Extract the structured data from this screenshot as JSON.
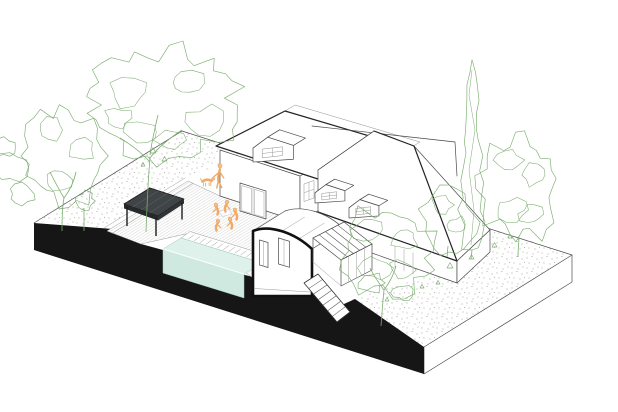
{
  "scene": {
    "kind": "architectural-axonometric-cutaway-illustration",
    "elements": [
      "garden-site-slab",
      "left-garden",
      "right-garden",
      "swimming-pool",
      "timber-deck",
      "pergola",
      "main-house",
      "roof-dormers",
      "sectioned-extension",
      "glazed-veranda",
      "exterior-stairs",
      "people-figures",
      "trees-and-shrubs"
    ]
  },
  "colors": {
    "background": "#ffffff",
    "line_dark": "#262626",
    "line_mid": "#4a4a4a",
    "line_light": "#9a9a9a",
    "poche_black": "#161616",
    "section_stroke": "#111111",
    "pool_water_top": "#def1ea",
    "pool_water_front": "#cfe9e1",
    "pool_line": "#9fccc2",
    "pergola_top": "#3f4446",
    "pergola_side": "#26292b",
    "pergola_side2": "#303436",
    "pergola_joist": "#5a5f61",
    "vegetation_green": "#7cad70",
    "figure_orange": "#f2a965",
    "figure_orange_dark": "#e2913f",
    "figure_skin": "#f6bd8a",
    "deck_hatch": "#b3b5b1",
    "stipple_gray": "#93978e",
    "table_line": "#c9c9c9"
  },
  "vegetation": [
    {
      "name": "large-tree-left",
      "kind": "canopy",
      "cx": 163,
      "cy": 105,
      "rx": 74,
      "ry": 54,
      "seed": 11,
      "clumps": [
        [
          128,
          92,
          20,
          14
        ],
        [
          186,
          83,
          18,
          13
        ],
        [
          204,
          122,
          20,
          15
        ],
        [
          142,
          132,
          17,
          12
        ],
        [
          118,
          118,
          13,
          10
        ],
        [
          170,
          140,
          15,
          10
        ]
      ],
      "trunk": [
        "M146,232 C147,205 148,180 150,158",
        "M150,158 C158,147 170,138 182,130",
        "M150,162 C141,152 130,144 120,138",
        "M150,155 C152,140 155,128 158,115"
      ]
    },
    {
      "name": "tree-left",
      "kind": "canopy",
      "cx": 64,
      "cy": 156,
      "rx": 42,
      "ry": 48,
      "seed": 22,
      "clumps": [
        [
          52,
          130,
          14,
          11
        ],
        [
          80,
          150,
          13,
          11
        ],
        [
          58,
          180,
          14,
          10
        ]
      ],
      "trunk": [
        "M62,231 C62,215 63,203 64,198",
        "M64,198 C58,188 54,180 50,172",
        "M64,198 C70,190 74,182 76,172"
      ]
    },
    {
      "name": "shrubs-left-edge",
      "kind": "blob",
      "blobs": [
        [
          10,
          168,
          17,
          14,
          31
        ],
        [
          22,
          194,
          13,
          10,
          32
        ],
        [
          4,
          148,
          11,
          9,
          33
        ]
      ]
    },
    {
      "name": "sapling-by-pergola",
      "kind": "canopy",
      "cx": 85,
      "cy": 201,
      "rx": 9,
      "ry": 9,
      "seed": 44,
      "clumps": [],
      "trunk": [
        "M84,231 L84,208"
      ]
    },
    {
      "name": "cypress-right",
      "kind": "cypress",
      "cx": 472,
      "top": 60,
      "bottom": 250,
      "w": 14,
      "seed": 55,
      "trunk": [
        "M472,250 L471,259"
      ]
    },
    {
      "name": "bushy-tree-right",
      "kind": "canopy",
      "cx": 520,
      "cy": 189,
      "rx": 38,
      "ry": 52,
      "seed": 66,
      "clumps": [
        [
          508,
          160,
          13,
          10
        ],
        [
          534,
          175,
          12,
          10
        ],
        [
          512,
          210,
          14,
          11
        ],
        [
          531,
          214,
          11,
          9
        ]
      ],
      "trunk": [
        "M518,257 C518,248 519,242 519,236"
      ]
    },
    {
      "name": "tree-center-front",
      "kind": "canopy",
      "cx": 387,
      "cy": 251,
      "rx": 48,
      "ry": 43,
      "seed": 77,
      "clumps": [
        [
          368,
          230,
          14,
          11
        ],
        [
          404,
          238,
          13,
          10
        ],
        [
          376,
          268,
          15,
          11
        ],
        [
          402,
          270,
          12,
          9
        ]
      ],
      "trunk": [
        "M381,326 C382,312 383,300 384,290",
        "M384,290 C378,282 374,276 370,268",
        "M384,290 C390,282 394,274 396,266"
      ]
    },
    {
      "name": "tree-by-house-right",
      "kind": "canopy",
      "cx": 449,
      "cy": 222,
      "rx": 27,
      "ry": 35,
      "seed": 88,
      "clumps": [
        [
          442,
          205,
          10,
          8
        ],
        [
          458,
          225,
          10,
          8
        ]
      ],
      "trunk": [
        "M447,257 L448,246"
      ]
    },
    {
      "name": "shrubs-right",
      "kind": "blob",
      "blobs": [
        [
          371,
          283,
          13,
          9,
          91
        ],
        [
          403,
          293,
          10,
          7,
          92
        ]
      ]
    },
    {
      "name": "ground-tufts",
      "kind": "tris",
      "pts": [
        [
          150,
          153,
          6
        ],
        [
          162,
          161,
          5
        ],
        [
          141,
          166,
          4
        ],
        [
          447,
          268,
          6
        ],
        [
          469,
          259,
          5
        ],
        [
          492,
          247,
          5
        ],
        [
          436,
          284,
          4
        ],
        [
          508,
          238,
          4
        ],
        [
          385,
          301,
          4
        ],
        [
          420,
          288,
          4
        ]
      ]
    }
  ],
  "figures": {
    "standing_person": {
      "x": 220,
      "y": 166
    },
    "dog": {
      "x": 207,
      "y": 181
    },
    "seated_group": {
      "cx": 224,
      "cy": 214,
      "members": [
        {
          "x": 216,
          "y": 205
        },
        {
          "x": 227,
          "y": 202
        },
        {
          "x": 235,
          "y": 210
        },
        {
          "x": 218,
          "y": 221
        },
        {
          "x": 230,
          "y": 219
        }
      ]
    }
  }
}
